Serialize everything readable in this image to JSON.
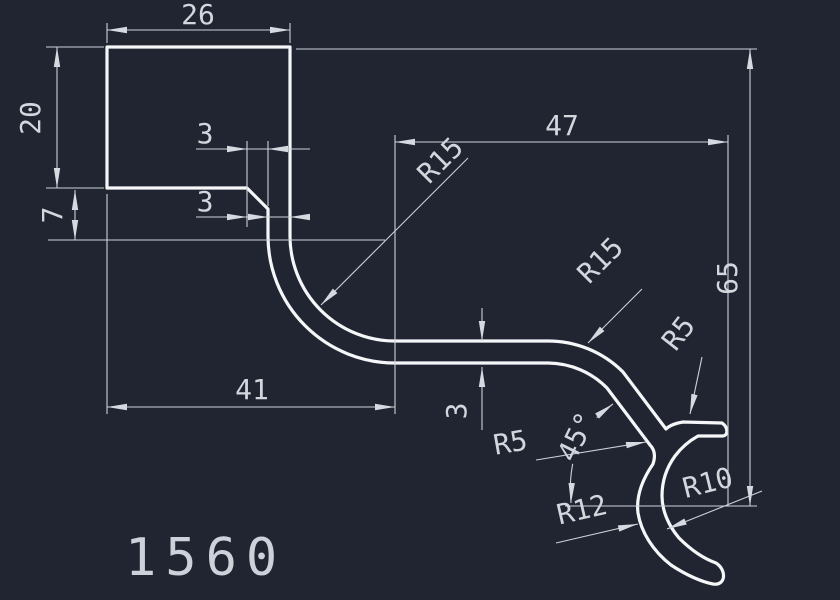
{
  "drawing": {
    "part_number": "1560",
    "dims": {
      "top_width": "26",
      "left_height": "20",
      "left_offset": "7",
      "chamfer": "3",
      "wall": "3",
      "mid_width": "47",
      "right_height": "65",
      "bottom_width": "41",
      "strip_thickness": "3",
      "angle": "45°",
      "r15_inner_fillet": "R15",
      "r15_bend": "R15",
      "r5_stub": "R5",
      "r5_crotch": "R5",
      "r12_outer": "R12",
      "r10_inner": "R10"
    },
    "colors": {
      "background": "#202531",
      "profile_line": "#f5f6f8",
      "dimension_line": "#ccd1d9",
      "text": "#d2d7de"
    }
  }
}
